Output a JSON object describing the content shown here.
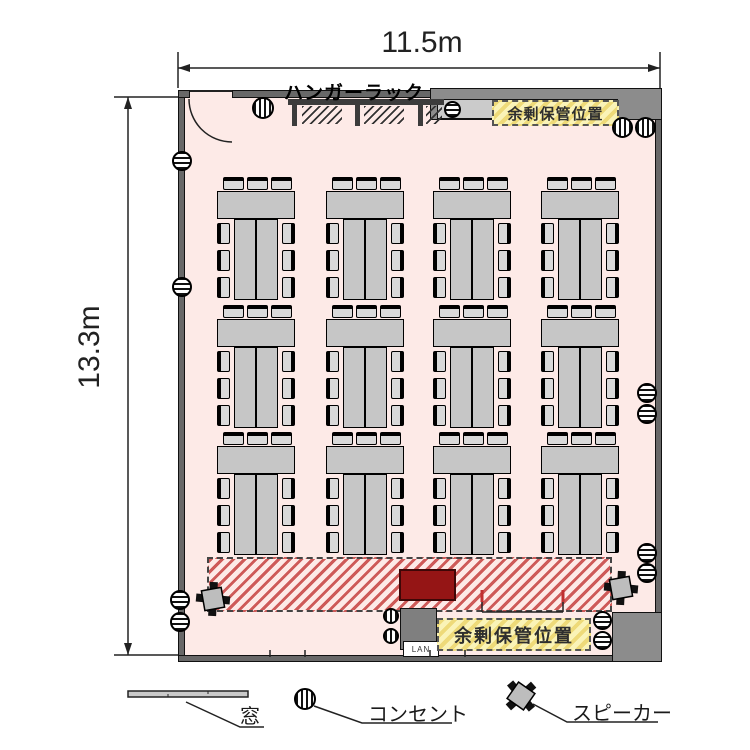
{
  "dimensions": {
    "width_label": "11.5m",
    "height_label": "13.3m"
  },
  "labels": {
    "hanger_rack": "ハンガーラック",
    "storage_top": "余剰保管位置",
    "storage_bottom": "余剰保管位置",
    "lan": "LAN"
  },
  "legend": [
    {
      "id": "window",
      "label": "窓"
    },
    {
      "id": "outlet",
      "label": "コンセント"
    },
    {
      "id": "speaker",
      "label": "スピーカー"
    }
  ],
  "floorplan": {
    "table_group_count": 12,
    "table_group_rows": 3,
    "table_group_columns": 4,
    "chairs_per_group": 9
  },
  "colors": {
    "floor": "#fdeae7",
    "wall": "#686868",
    "furniture": "#c6c6c6",
    "stage_hatch": "#c64040",
    "stage_block": "#951515",
    "storage_fill": "#faf3b7",
    "storage_hatch": "#eeda79"
  }
}
